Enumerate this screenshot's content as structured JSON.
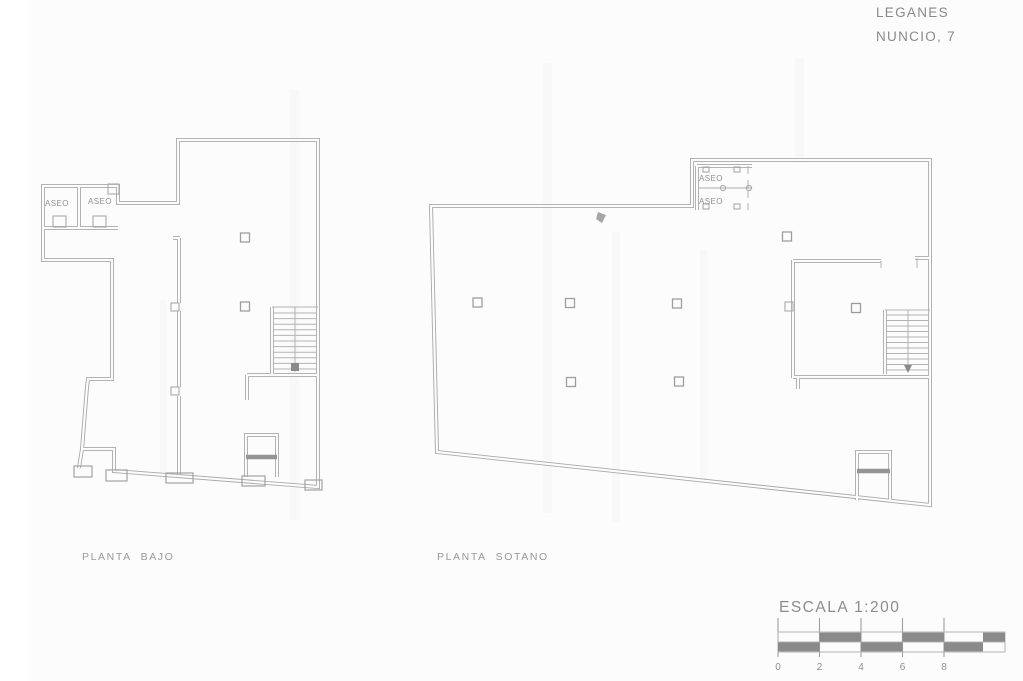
{
  "document": {
    "type": "architectural-floor-plan-sheet",
    "colors": {
      "paper": "#fcfcfc",
      "wall_line": "#a9a9a9",
      "text": "#8d8d8d",
      "scale_bar_dark": "#8a8a8a"
    }
  },
  "header": {
    "location": "LEGANES",
    "address": "NUNCIO, 7"
  },
  "plans": [
    {
      "id": "planta-bajo",
      "label": "PLANTA BAJO",
      "rooms": [
        {
          "label": "ASEO"
        },
        {
          "label": "ASEO"
        }
      ]
    },
    {
      "id": "planta-sotano",
      "label": "PLANTA SOTANO",
      "rooms": [
        {
          "label": "ASEO"
        },
        {
          "label": "ASEO"
        }
      ]
    }
  ],
  "scale": {
    "title": "ESCALA 1:200",
    "tick_labels": [
      "0",
      "2",
      "4",
      "6",
      "8"
    ]
  }
}
